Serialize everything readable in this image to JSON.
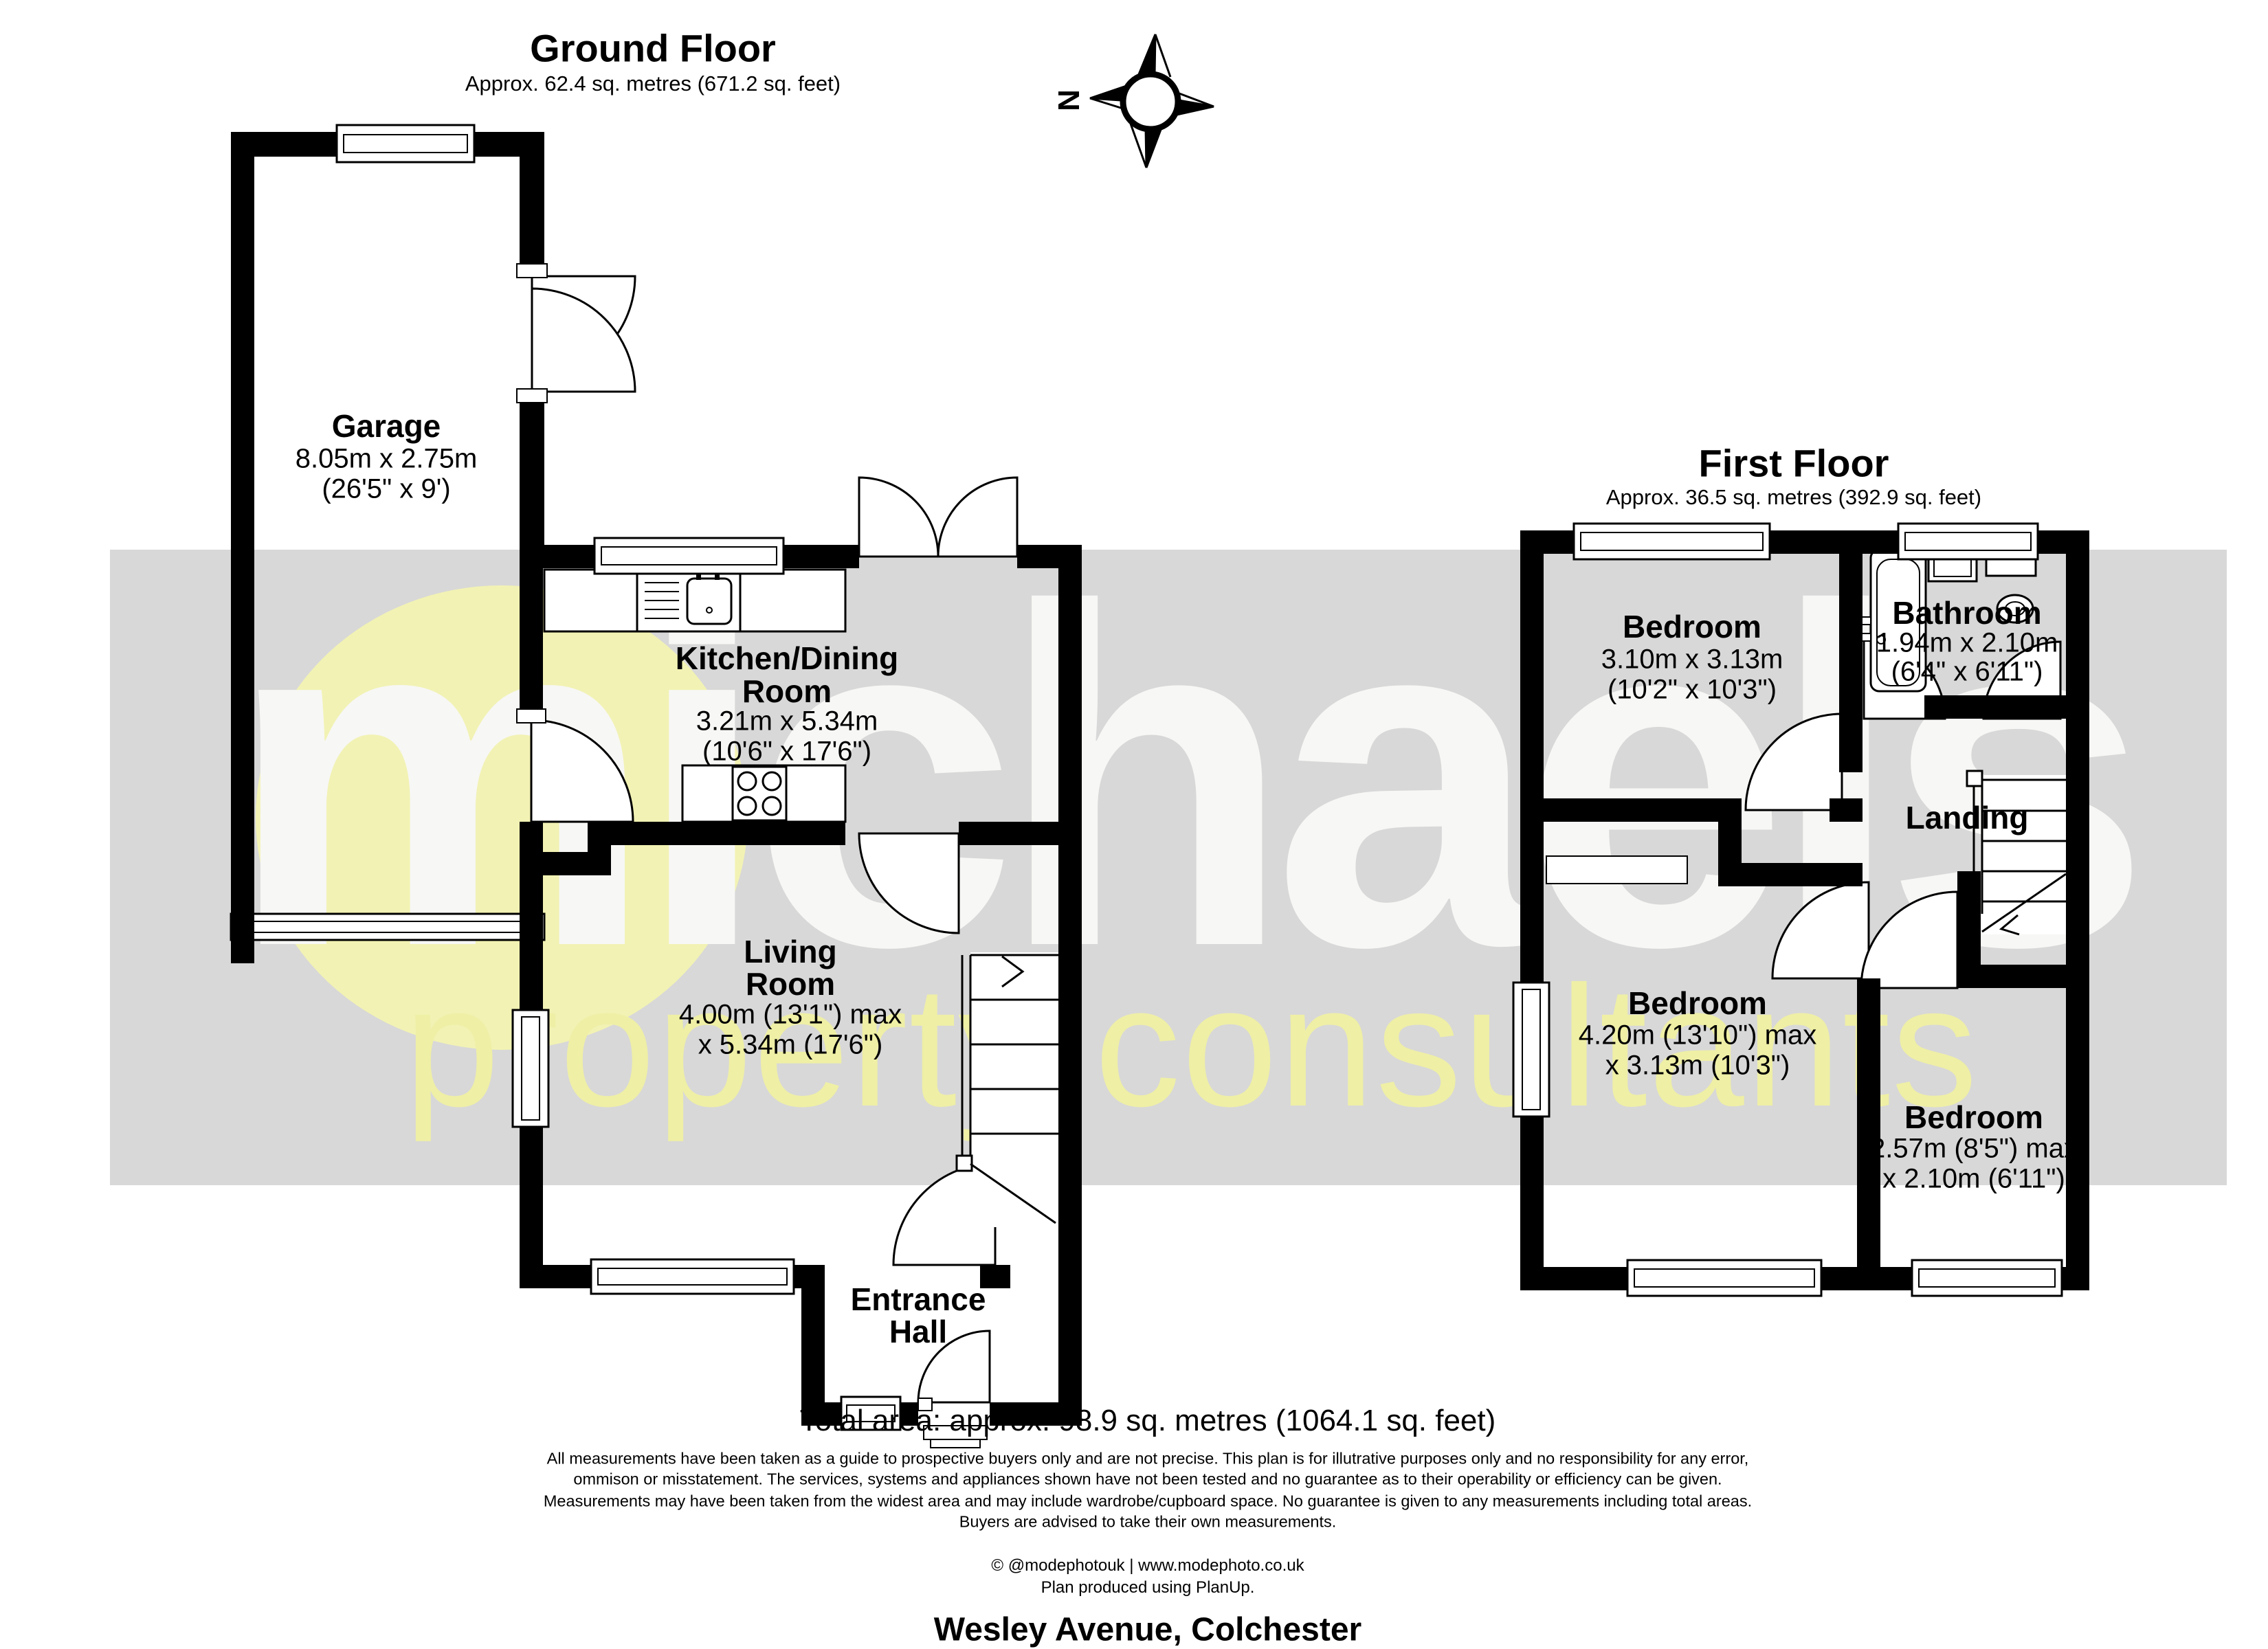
{
  "ground_floor": {
    "title": "Ground Floor",
    "approx": "Approx. 62.4 sq. metres (671.2 sq. feet)",
    "garage": {
      "name": "Garage",
      "metric": "8.05m x 2.75m",
      "imperial": "(26'5\" x 9')"
    },
    "kitchen": {
      "name_line1": "Kitchen/Dining",
      "name_line2": "Room",
      "metric": "3.21m x 5.34m",
      "imperial": "(10'6\" x 17'6\")"
    },
    "living": {
      "name_line1": "Living",
      "name_line2": "Room",
      "metric": "4.00m (13'1\") max",
      "imperial": "x 5.34m (17'6\")"
    },
    "hall": {
      "name_line1": "Entrance",
      "name_line2": "Hall"
    }
  },
  "first_floor": {
    "title": "First Floor",
    "approx": "Approx. 36.5 sq. metres (392.9 sq. feet)",
    "bedroom1": {
      "name": "Bedroom",
      "metric": "3.10m x 3.13m",
      "imperial": "(10'2\" x 10'3\")"
    },
    "bathroom": {
      "name": "Bathroom",
      "metric": "1.94m x 2.10m",
      "imperial": "(6'4\" x 6'11\")"
    },
    "landing": {
      "name": "Landing"
    },
    "bedroom2": {
      "name": "Bedroom",
      "metric": "4.20m (13'10\") max",
      "imperial": "x 3.13m (10'3\")"
    },
    "bedroom3": {
      "name": "Bedroom",
      "metric": "2.57m (8'5\") max",
      "imperial": "x 2.10m (6'11\")"
    }
  },
  "footer": {
    "total": "Total area: approx. 98.9 sq. metres (1064.1 sq. feet)",
    "disclaimer": [
      "All measurements have been taken as a guide to prospective buyers only and are not precise. This plan is for illutrative purposes only and no responsibility for any error,",
      "ommison or misstatement. The services, systems and appliances shown have not been tested and no guarantee as to their operability or efficiency can be given.",
      "Measurements may have been taken from the widest area and may include wardrobe/cupboard space. No guarantee is given to any measurements including total areas.",
      "Buyers are advised to take their own measurements."
    ],
    "copyright": "© @modephotouk | www.modephoto.co.uk",
    "produced": "Plan produced using PlanUp.",
    "address": "Wesley Avenue, Colchester"
  },
  "watermark": {
    "brand": "michaels",
    "tagline": "property consultants"
  },
  "compass": {
    "north": "N"
  },
  "colors": {
    "wall": "#000000",
    "band": "#d8d8d8",
    "brand_text": "#f7f7f5",
    "accent_yellow": "#f2f2b4"
  }
}
